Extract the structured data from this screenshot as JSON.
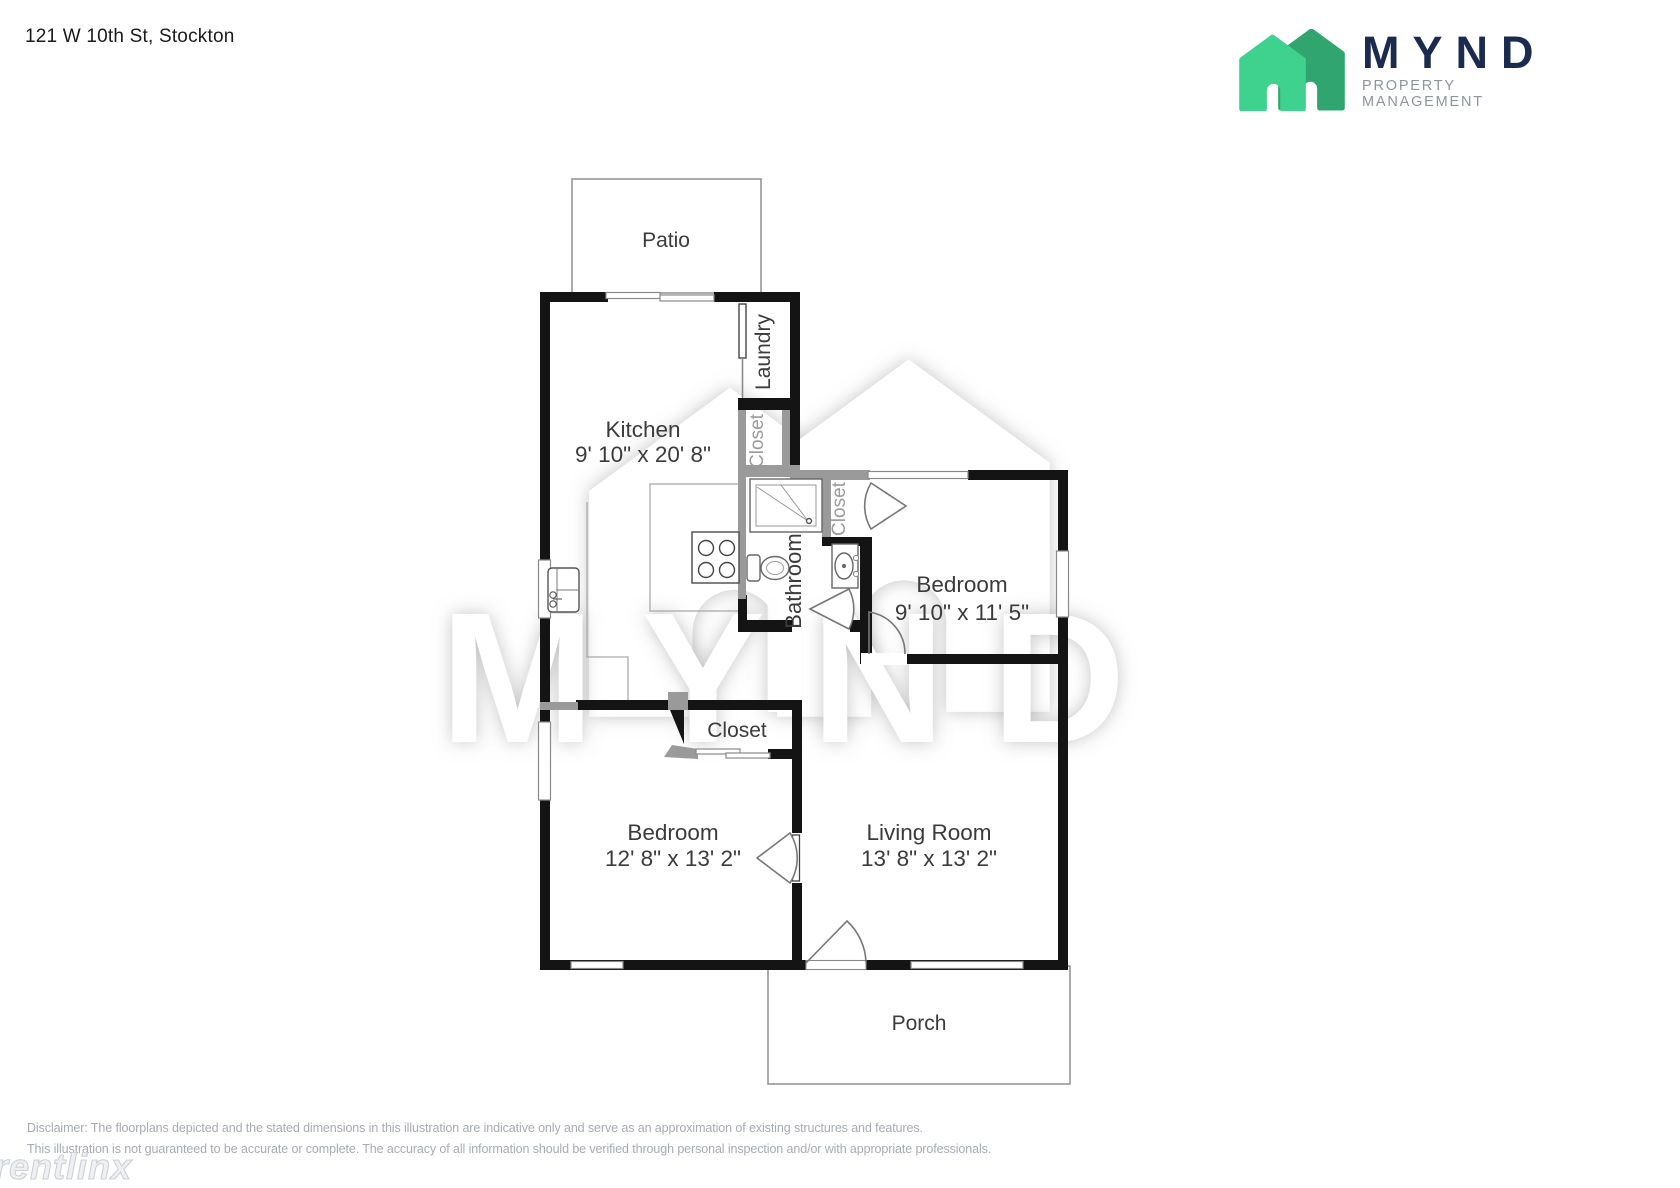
{
  "header": {
    "address": "121 W 10th St, Stockton"
  },
  "logo": {
    "brand": "MYND",
    "tagline": "PROPERTY MANAGEMENT",
    "colors": {
      "navy": "#1b2b50",
      "green_light": "#3ed28e",
      "green_dark": "#31a56f"
    }
  },
  "rooms": {
    "patio": {
      "name": "Patio"
    },
    "kitchen": {
      "name": "Kitchen",
      "dims": "9' 10\" x 20' 8\""
    },
    "laundry": {
      "name": "Laundry"
    },
    "closet_laundry": {
      "name": "Closet"
    },
    "bathroom": {
      "name": "Bathroom"
    },
    "closet_bedroom1": {
      "name": "Closet"
    },
    "bedroom1": {
      "name": "Bedroom",
      "dims": "9' 10\" x 11' 5\""
    },
    "closet_hall": {
      "name": "Closet"
    },
    "bedroom2": {
      "name": "Bedroom",
      "dims": "12' 8\" x 13' 2\""
    },
    "living_room": {
      "name": "Living Room",
      "dims": "13' 8\" x 13' 2\""
    },
    "porch": {
      "name": "Porch"
    }
  },
  "watermark": {
    "brand": "MYND",
    "provider": "rentlinx"
  },
  "footer": {
    "line1": "Disclaimer: The floorplans depicted and the stated dimensions in this illustration are indicative only and serve as an approximation of existing structures and features.",
    "line2": "This illustration is not guaranteed to be accurate or complete. The accuracy of all information should be verified through personal inspection and/or with appropriate professionals."
  },
  "plan_colors": {
    "wall": "#141414",
    "closet_wall": "#9a9a9a"
  }
}
